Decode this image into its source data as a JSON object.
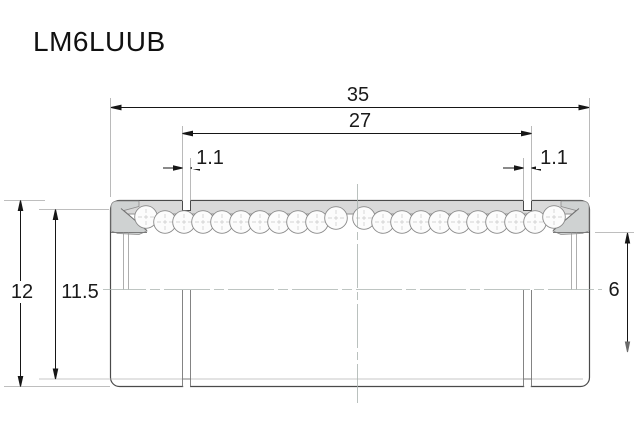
{
  "title": "LM6LUUB",
  "dimensions": {
    "overall_length": {
      "label": "35"
    },
    "groove_spacing": {
      "label": "27"
    },
    "groove_width_left": {
      "label": "1.1"
    },
    "groove_width_right": {
      "label": "1.1"
    },
    "outer_diameter": {
      "label": "12"
    },
    "groove_diameter": {
      "label": "11.5"
    },
    "bore_diameter": {
      "label": "6"
    }
  }
}
